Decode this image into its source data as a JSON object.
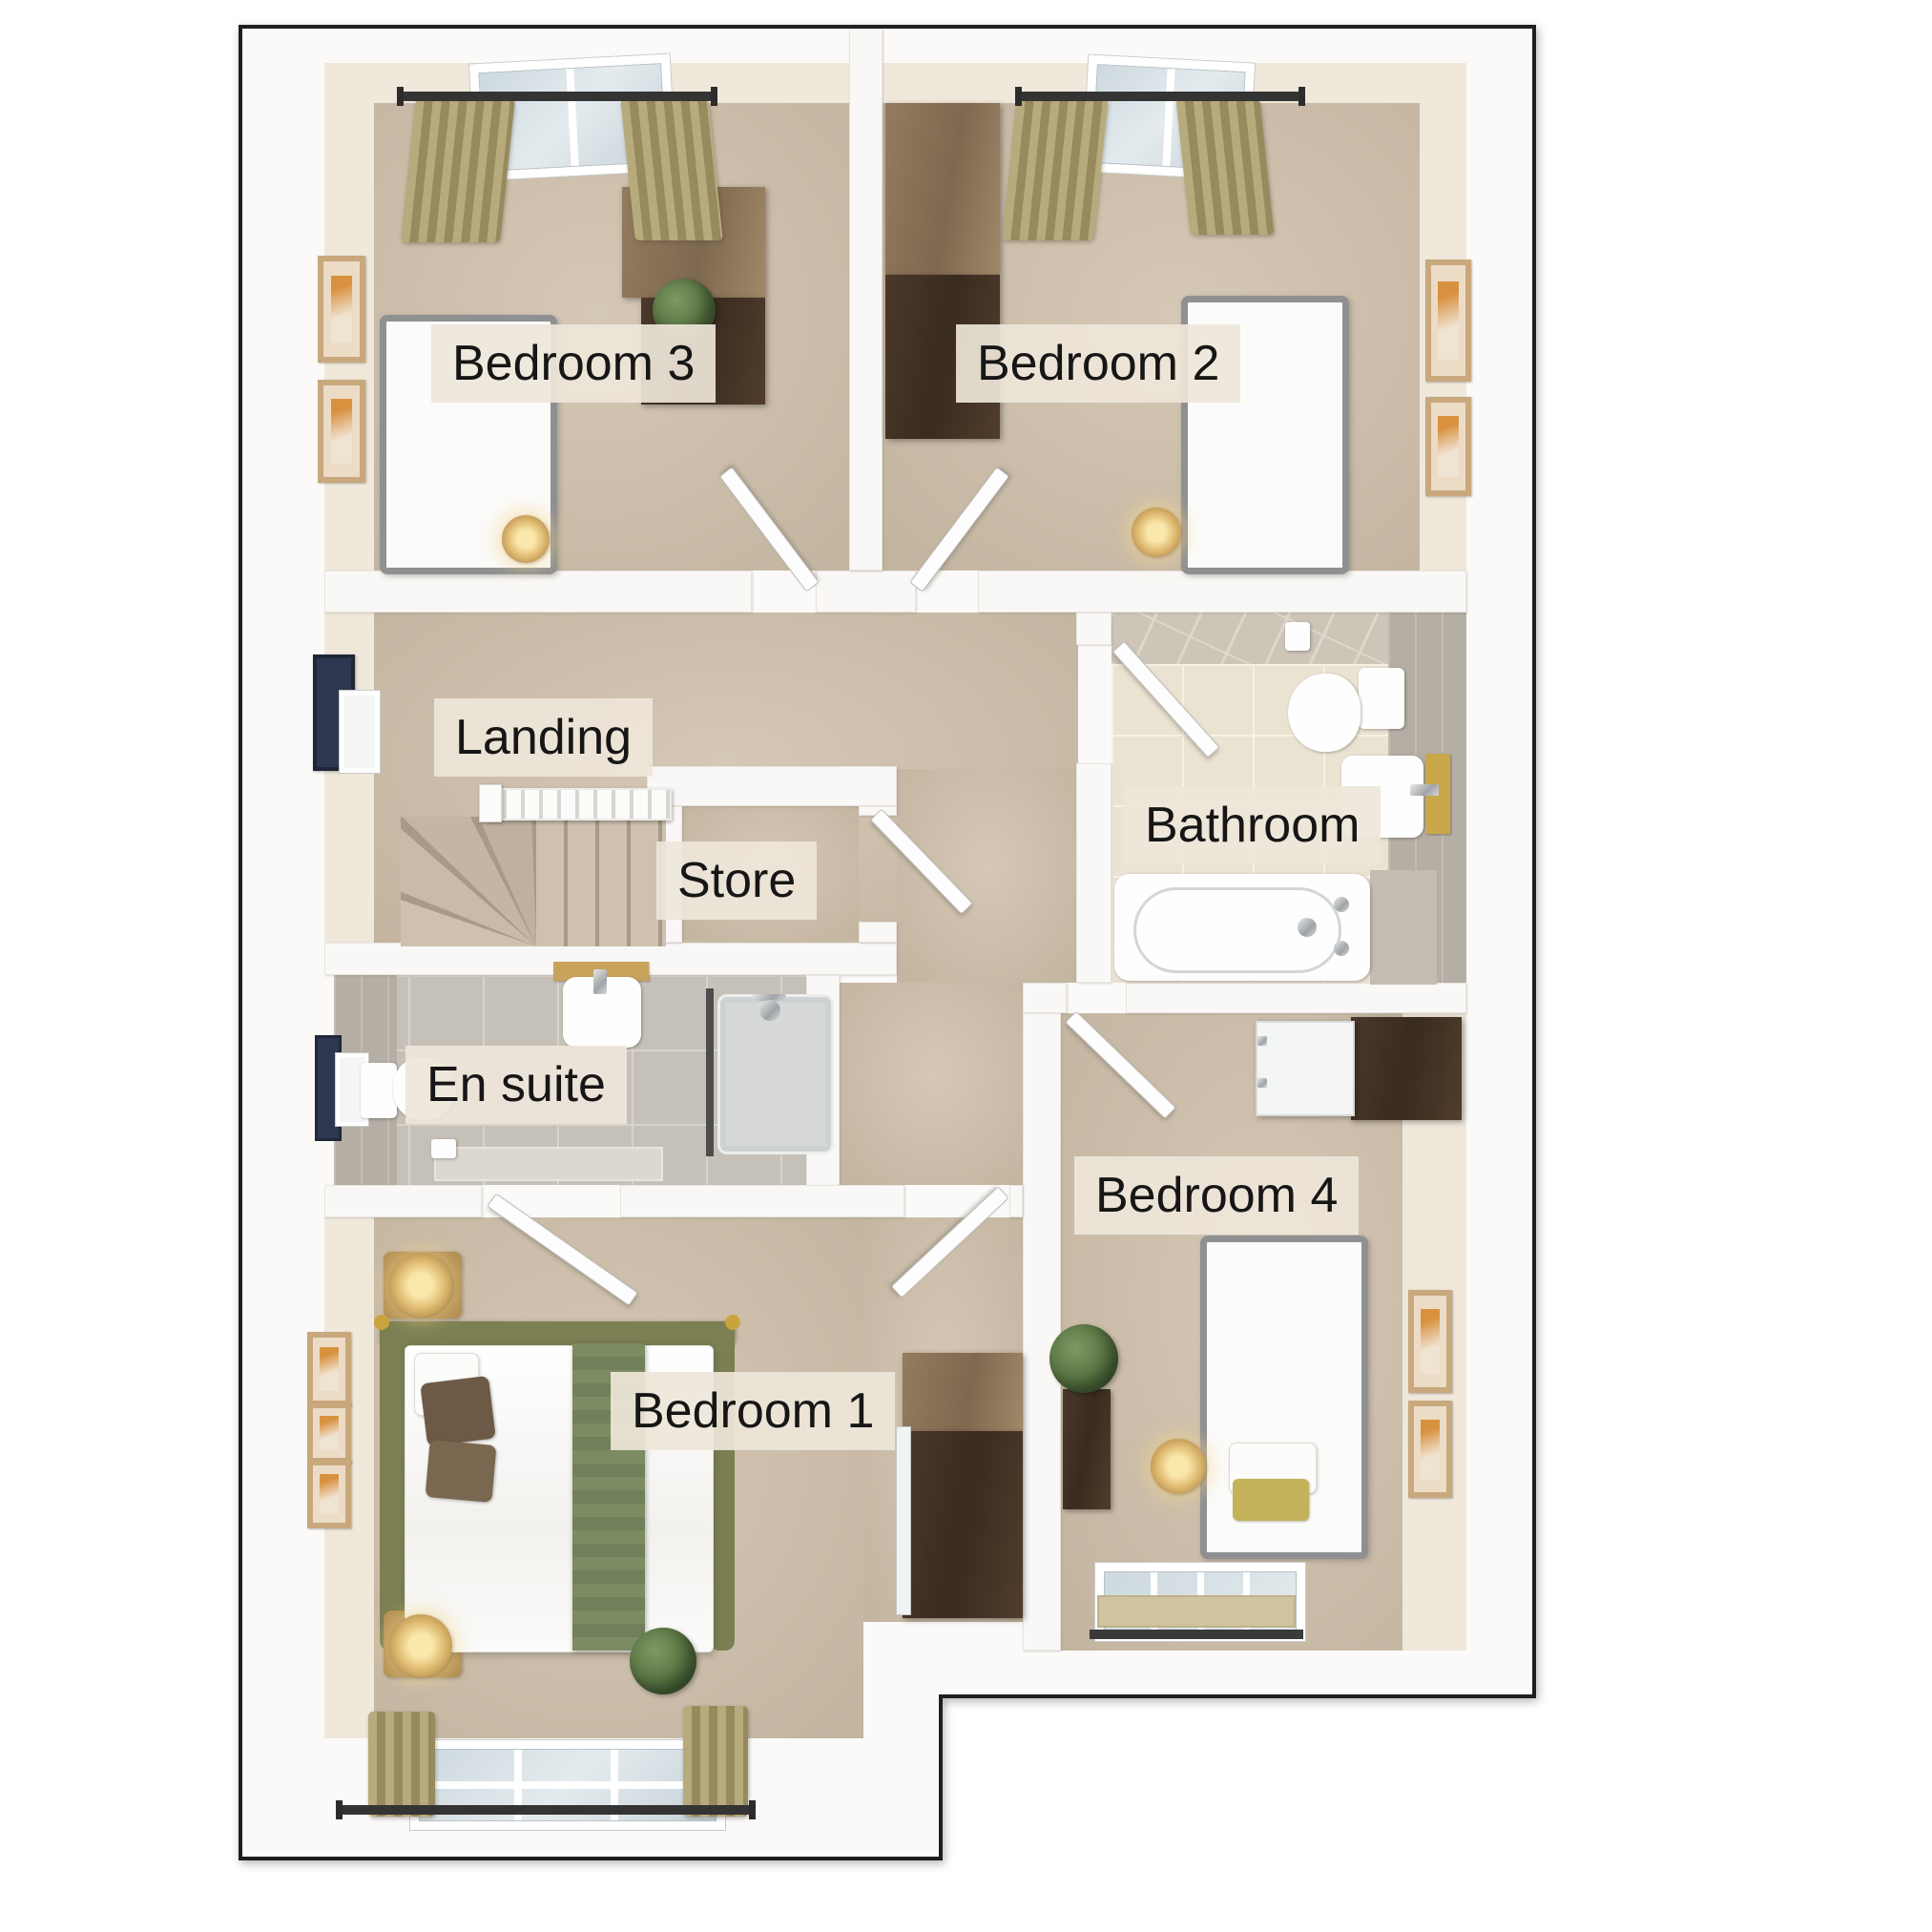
{
  "page": {
    "background_color": "#ffffff"
  },
  "floorplan": {
    "type": "3d-top-down-residential-floor-plan",
    "rooms": [
      {
        "id": "bedroom-3",
        "label": "Bedroom 3",
        "furniture": [
          "single bed with olive duvet",
          "desk",
          "drawer unit",
          "plant",
          "bedside lamp",
          "two wall pictures",
          "window with curtains",
          "door"
        ]
      },
      {
        "id": "bedroom-2",
        "label": "Bedroom 2",
        "furniture": [
          "single bed with olive duvet",
          "wardrobe",
          "bedside lamp",
          "two wall pictures",
          "window with curtains",
          "door"
        ]
      },
      {
        "id": "landing",
        "label": "Landing",
        "furniture": [
          "staircase with handrail and winders",
          "wall picture",
          "small window"
        ]
      },
      {
        "id": "store",
        "label": "Store",
        "furniture": [
          "door"
        ]
      },
      {
        "id": "bathroom",
        "label": "Bathroom",
        "furniture": [
          "bath with taps",
          "toilet",
          "wash basin with towel",
          "toilet-roll holder",
          "door"
        ]
      },
      {
        "id": "en-suite",
        "label": "En suite",
        "furniture": [
          "shower enclosure",
          "toilet",
          "wash basin with shelf",
          "toilet-roll holder",
          "small window",
          "door"
        ]
      },
      {
        "id": "bedroom-1",
        "label": "Bedroom 1",
        "furniture": [
          "double bed with green throw",
          "two bedside tables with lamps",
          "wardrobe with mirror",
          "plant",
          "three wall pictures",
          "window with curtains",
          "door"
        ]
      },
      {
        "id": "bedroom-4",
        "label": "Bedroom 4",
        "furniture": [
          "single bed with olive duvet",
          "dresser with mirror doors",
          "chest with plant",
          "bedside lamp",
          "two wall pictures",
          "window with blind",
          "door"
        ]
      }
    ],
    "colors": {
      "carpet": "#cbbda9",
      "wall": "#f9f8f6",
      "building_outline": "#1f1f1f",
      "label_background": "#eee6d9",
      "label_text": "#161616",
      "accent_olive": "#a8973f",
      "wood_dark": "#42342a",
      "wood_light": "#8a7257",
      "bathroom_tile": "#ebe3d2",
      "ensuite_tile": "#c6c1b8",
      "curtain": "#a89b6d",
      "plant_green": "#55713f"
    }
  }
}
